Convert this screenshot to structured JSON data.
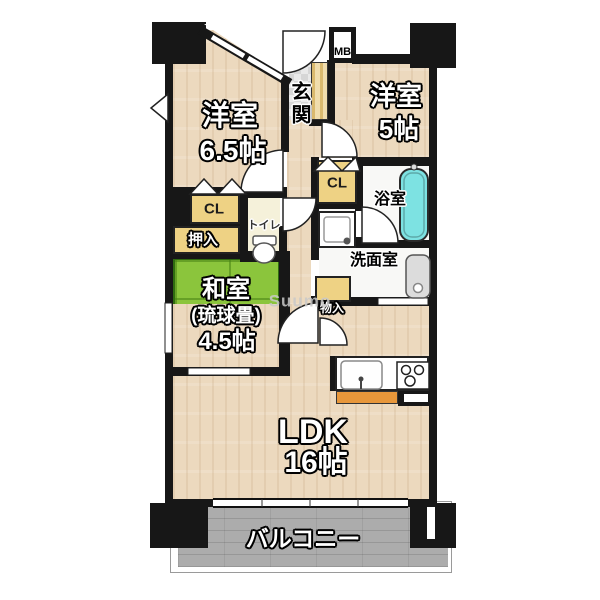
{
  "plan": {
    "type": "apartment-floor-plan",
    "labels": {
      "w1_name": "洋室",
      "w1_size": "6.5帖",
      "w2_name": "洋室",
      "w2_size": "5帖",
      "washitsu_name": "和室",
      "washitsu_sub": "(琉球畳)",
      "washitsu_size": "4.5帖",
      "ldk_name": "LDK",
      "ldk_size": "16帖",
      "genkan": "玄関",
      "mb": "MB",
      "cl_a": "CL",
      "cl_b": "CL",
      "oshiire": "押入",
      "toilet": "トイレ",
      "bath": "浴室",
      "wash": "洗面室",
      "storage": "物入",
      "balcony": "バルコニー",
      "watermark": "Suumo"
    },
    "colors": {
      "wall": "#171717",
      "wood_floor": "#ecd9be",
      "tatami_green": "#8bc53c",
      "closet_tan": "#eed284",
      "bathtub_cyan": "#7de2e2",
      "balcony_gray": "#acacac",
      "kitchen_counter_orange": "#e8973a",
      "entrance_tile": "#e3e3e3"
    }
  }
}
